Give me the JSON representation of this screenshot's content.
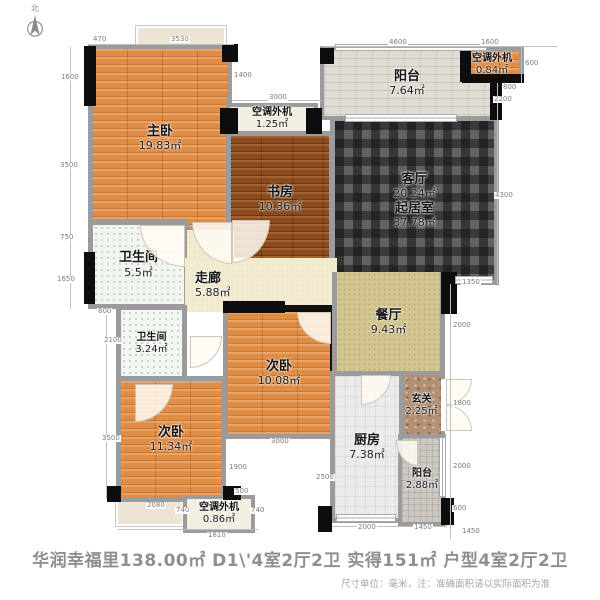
{
  "compass": {
    "label": "北"
  },
  "rooms": [
    {
      "id": "master-bedroom",
      "name": "主卧",
      "area": "19.83㎡"
    },
    {
      "id": "study",
      "name": "书房",
      "area": "10.36㎡"
    },
    {
      "id": "balcony-top",
      "name": "阳台",
      "area": "7.64㎡"
    },
    {
      "id": "ac-unit-top",
      "name": "空调外机",
      "area": "1.25㎡"
    },
    {
      "id": "ac-unit-right",
      "name": "空调外机",
      "area": "0.84㎡"
    },
    {
      "id": "living-room",
      "name": "客厅",
      "area": "20.24㎡",
      "name2": "起居室",
      "area2": "37.78㎡"
    },
    {
      "id": "bathroom-1",
      "name": "卫生间",
      "area": "5.5㎡"
    },
    {
      "id": "corridor",
      "name": "走廊",
      "area": "5.88㎡"
    },
    {
      "id": "bathroom-2",
      "name": "卫生间",
      "area": "3.24㎡"
    },
    {
      "id": "bedroom-2",
      "name": "次卧",
      "area": "10.08㎡"
    },
    {
      "id": "bedroom-3",
      "name": "次卧",
      "area": "11.34㎡"
    },
    {
      "id": "dining-room",
      "name": "餐厅",
      "area": "9.43㎡"
    },
    {
      "id": "entry",
      "name": "玄关",
      "area": "2.25㎡"
    },
    {
      "id": "kitchen",
      "name": "厨房",
      "area": "7.38㎡"
    },
    {
      "id": "balcony-bottom",
      "name": "阳台",
      "area": "2.88㎡"
    },
    {
      "id": "ac-unit-bottom",
      "name": "空调外机",
      "area": "0.86㎡"
    }
  ],
  "dims": [
    "470",
    "3530",
    "4600",
    "1600",
    "1400",
    "3000",
    "600",
    "800",
    "2200",
    "4300",
    "1350",
    "2000",
    "1800",
    "2000",
    "600",
    "1450",
    "1600",
    "3500",
    "750",
    "1650",
    "800",
    "2100",
    "3500",
    "2080",
    "740",
    "1810",
    "740",
    "500",
    "1900",
    "3000",
    "2500",
    "2000",
    "1450"
  ],
  "footer": {
    "title": "华润幸福里138.00㎡ D1\\'4室2厅2卫 实得151㎡ 户型4室2厅2卫",
    "note": "尺寸单位：毫米，注：准确面积请以实际面积为准"
  },
  "colors": {
    "wood": "#e08c45",
    "wood_dark": "#8b4b1d",
    "living_tile": "#5c5c5c",
    "corridor_cream": "#f2ebd0",
    "dining_olive": "#d3c58f",
    "entry_marble": "#b29076",
    "wall_gray": "#9b9b9b",
    "column_black": "#0d0d0d",
    "footer_text": "#8f8f8f"
  }
}
